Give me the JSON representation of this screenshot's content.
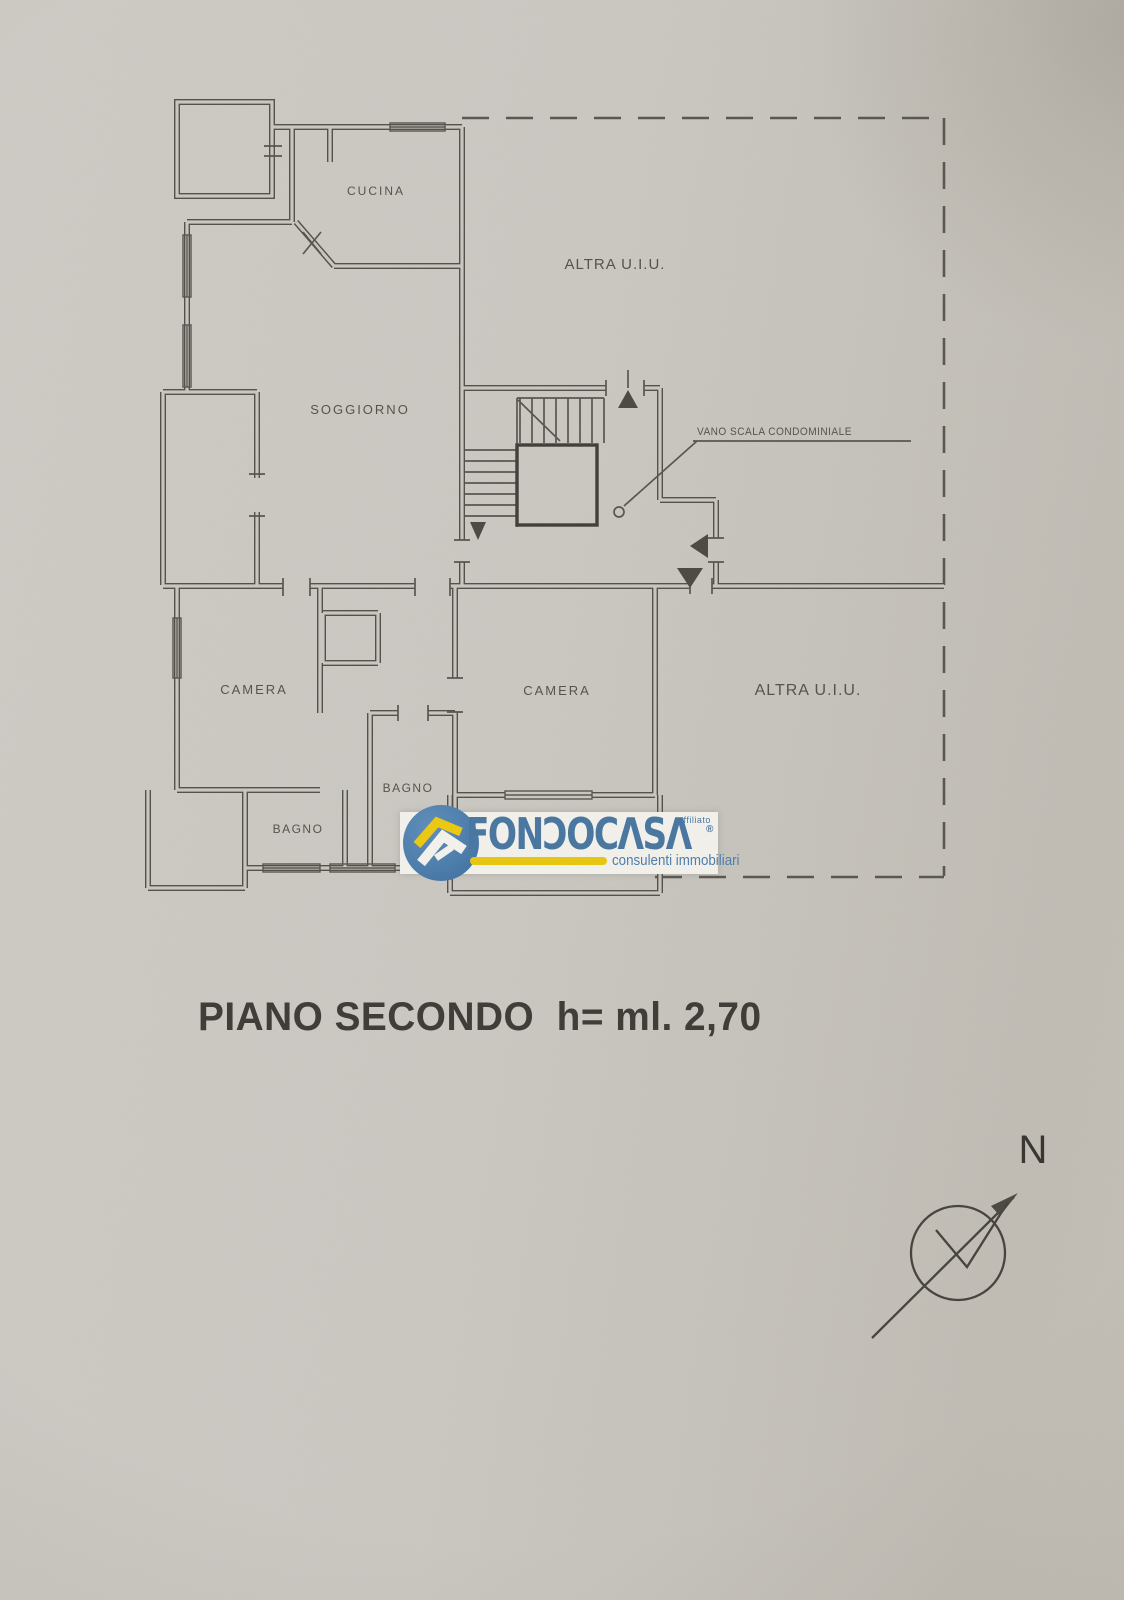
{
  "plan": {
    "rooms": [
      "CUCINA",
      "SOGGIORNO",
      "CAMERA",
      "CAMERA",
      "BAGNO",
      "BAGNO"
    ],
    "adjacent_units": [
      "ALTRA U.I.U.",
      "ALTRA U.I.U."
    ],
    "stair_callout": "VANO SCALA CONDOMINIALE"
  },
  "caption": {
    "text": "PIANO SECONDO  h= ml. 2,70"
  },
  "compass": {
    "label": "N"
  },
  "watermark": {
    "brand": "FONDOCASA",
    "brand_stylized": "FONƆOCΛSΛ",
    "registered": "®",
    "affiliate_label": "affiliato",
    "tagline": "consulenti immobiliari",
    "colors": {
      "blue": "#4a7cac",
      "yellow": "#e7c60e",
      "band": "#f3f1eb"
    }
  },
  "paper": {
    "background": "#c9c6c0",
    "line_color": "#514e48"
  }
}
